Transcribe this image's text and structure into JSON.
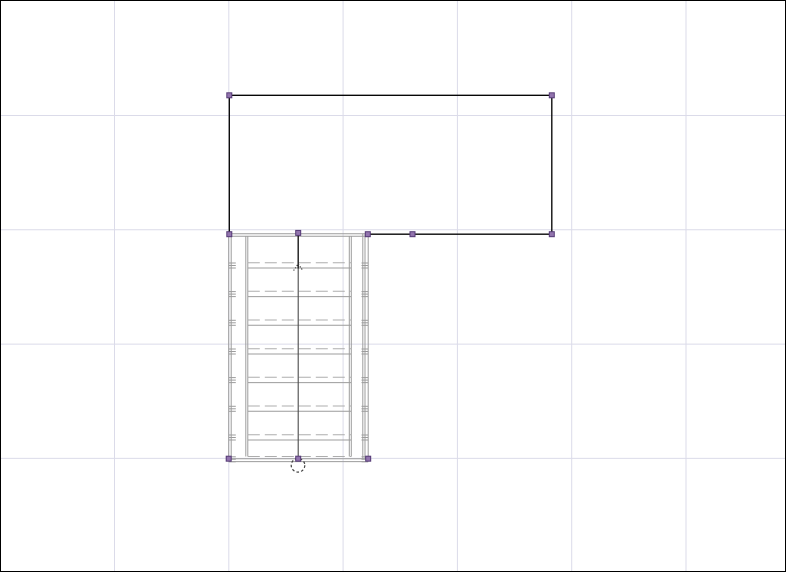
{
  "app": {
    "name": "floor-plan-editor",
    "canvas_background": "#ffffff",
    "canvas_border_color": "#000000",
    "canvas_width": 786,
    "canvas_height": 572
  },
  "grid": {
    "color": "#dbdbe9",
    "line_width": 1,
    "vertical_x": [
      114.5,
      228.8,
      343.1,
      457.4,
      571.7,
      686.0
    ],
    "horizontal_y": [
      115.5,
      229.8,
      344.1,
      458.4
    ]
  },
  "room": {
    "stroke": "#060606",
    "line_width": 1.35,
    "segments": [
      [
        229.3,
        95.3,
        551.8,
        95.3
      ],
      [
        229.3,
        95.3,
        229.3,
        234.2
      ],
      [
        551.8,
        95.3,
        551.8,
        234.2
      ],
      [
        367.8,
        234.2,
        551.8,
        234.2
      ]
    ]
  },
  "staircase": {
    "stroke": "#9c9c9c",
    "dashed_stroke": "#adadad",
    "line_width": 1,
    "bounds": {
      "x1": 228.7,
      "y1": 233.7,
      "x2": 368.2,
      "y2": 458.7
    },
    "boundary_horizontals": [
      [
        228.7,
        233.7,
        368.2,
        233.7
      ],
      [
        228.7,
        236.2,
        368.2,
        236.2
      ],
      [
        228.7,
        458.7,
        368.2,
        458.7
      ],
      [
        228.7,
        461.6,
        368.2,
        461.6
      ]
    ],
    "verticals": [
      [
        228.7,
        233.7,
        458.7
      ],
      [
        231.2,
        233.7,
        458.7
      ],
      [
        245.8,
        236.2,
        456.5
      ],
      [
        247.8,
        236.2,
        456.5
      ],
      [
        349.3,
        236.2,
        456.5
      ],
      [
        351.3,
        236.2,
        456.5
      ],
      [
        362.8,
        233.7,
        458.7
      ],
      [
        365.0,
        233.7,
        458.7
      ],
      [
        368.2,
        233.7,
        458.7
      ]
    ],
    "tread_x1": 247.8,
    "tread_x2": 351.3,
    "tread_y": [
      268.0,
      296.6,
      325.3,
      354.0,
      382.6,
      411.3,
      440.0
    ],
    "dashed_y": [
      262.7,
      291.3,
      320.0,
      348.7,
      377.3,
      406.0,
      434.7,
      456.5
    ],
    "dash_pattern": "12 5",
    "rail_mark_zones": [
      [
        228.7,
        235.8
      ],
      [
        361.5,
        368.2
      ]
    ],
    "rail_mark_dy": [
      0.3,
      2.8,
      5.3
    ],
    "direction_line": {
      "x": 298.2,
      "top_y": 232.7,
      "split_y": 268.5,
      "bottom_y": 458.9,
      "upper_stroke": "#1a1a1a",
      "upper_width": 1.4,
      "lower_stroke": "#4a4a4a",
      "lower_width": 1.1
    },
    "arrow_head": {
      "points": "293.6,270.6 298.2,263.8 302.8,270.6",
      "stroke": "#3a3a3a",
      "dash": "1.2 1.6"
    },
    "start_circle": {
      "cx": 298.0,
      "cy": 465.3,
      "r": 6.8,
      "stroke": "#3f3f3f",
      "dash": "2.6 2.2"
    }
  },
  "selection": {
    "handle_fill": "#9274ae",
    "handle_stroke": "#553a76",
    "handle_size": 5,
    "handles": [
      [
        229.3,
        95.3
      ],
      [
        551.8,
        95.3
      ],
      [
        229.3,
        234.2
      ],
      [
        298.2,
        232.9
      ],
      [
        367.8,
        234.2
      ],
      [
        412.5,
        234.2
      ],
      [
        551.8,
        234.2
      ],
      [
        228.7,
        458.7
      ],
      [
        298.2,
        458.7
      ],
      [
        368.2,
        458.7
      ]
    ]
  }
}
